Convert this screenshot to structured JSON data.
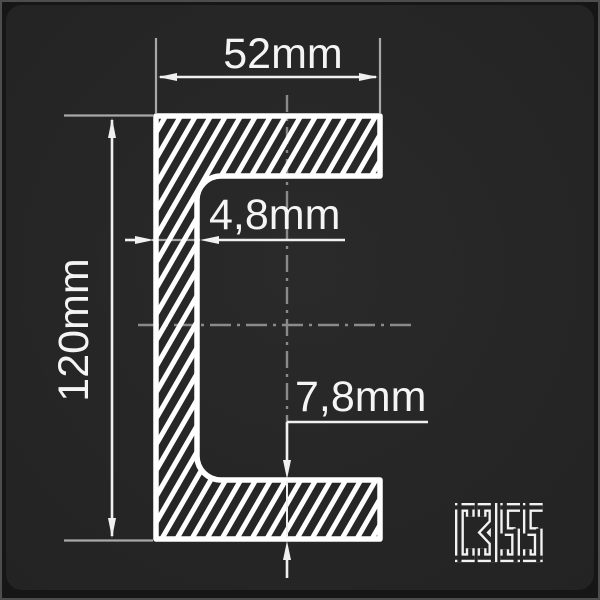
{
  "card": {
    "background": "#262626",
    "edge_highlight": "#4d4d4d",
    "outer_background": "#161616"
  },
  "drawing": {
    "type": "technical-drawing",
    "subject": "C-channel steel profile cross-section",
    "hatch_style": "diagonal-60deg-white",
    "dimensions": {
      "flange_width": {
        "label": "52mm",
        "value": 52,
        "unit": "mm"
      },
      "profile_height": {
        "label": "120mm",
        "value": 120,
        "unit": "mm"
      },
      "web_thickness": {
        "label": "4,8mm",
        "value": 4.8,
        "unit": "mm"
      },
      "flange_thickness": {
        "label": "7,8mm",
        "value": 7.8,
        "unit": "mm"
      }
    },
    "grade": {
      "label": "C355"
    },
    "colors": {
      "outline": "#ffffff",
      "dimension_line": "#f0f0f0",
      "extension_line": "#a8a8a8",
      "centerline": "#8a8a8a",
      "text": "#f4f4f4"
    }
  }
}
